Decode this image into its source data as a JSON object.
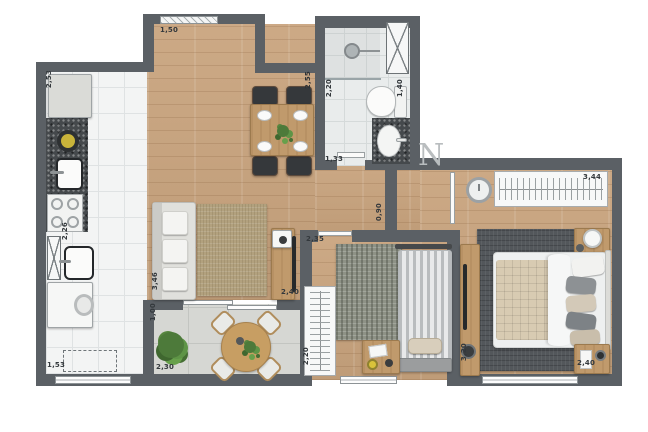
{
  "watermark": {
    "letter": "N"
  },
  "dims": {
    "top_window": "1,50",
    "kitchen_top": "2,53",
    "kitchen_mid": "2,26",
    "laundry": "1,53",
    "dining_wall": "2,55",
    "bath_width": "2,20",
    "bath_depth": "1,40",
    "bath_length": "1,33",
    "hall": "0,90",
    "living_length": "3,46",
    "living_width": "2,40",
    "balcony_depth": "1,00",
    "balcony_width": "2,30",
    "balcony_side": "2,20",
    "bedroom2_width": "2,35",
    "bedroom2_length": "3,20",
    "bedroom1_length": "3,44",
    "bedroom1_width": "2,40"
  },
  "colors": {
    "wall": "#5b6065",
    "wood_floor": "#c9a47e",
    "kitchen_tile": "#f3f4f4",
    "balcony_tile": "#d6d7d3",
    "bath_tile": "#e9ecec",
    "granite": "#45494c",
    "living_rug": "#b2a17e",
    "master_rug": "#53575b",
    "bedroom2_rug": "#8e9286",
    "plant_green": "#4d7a3a",
    "furniture_wood": "#c09a6c"
  }
}
